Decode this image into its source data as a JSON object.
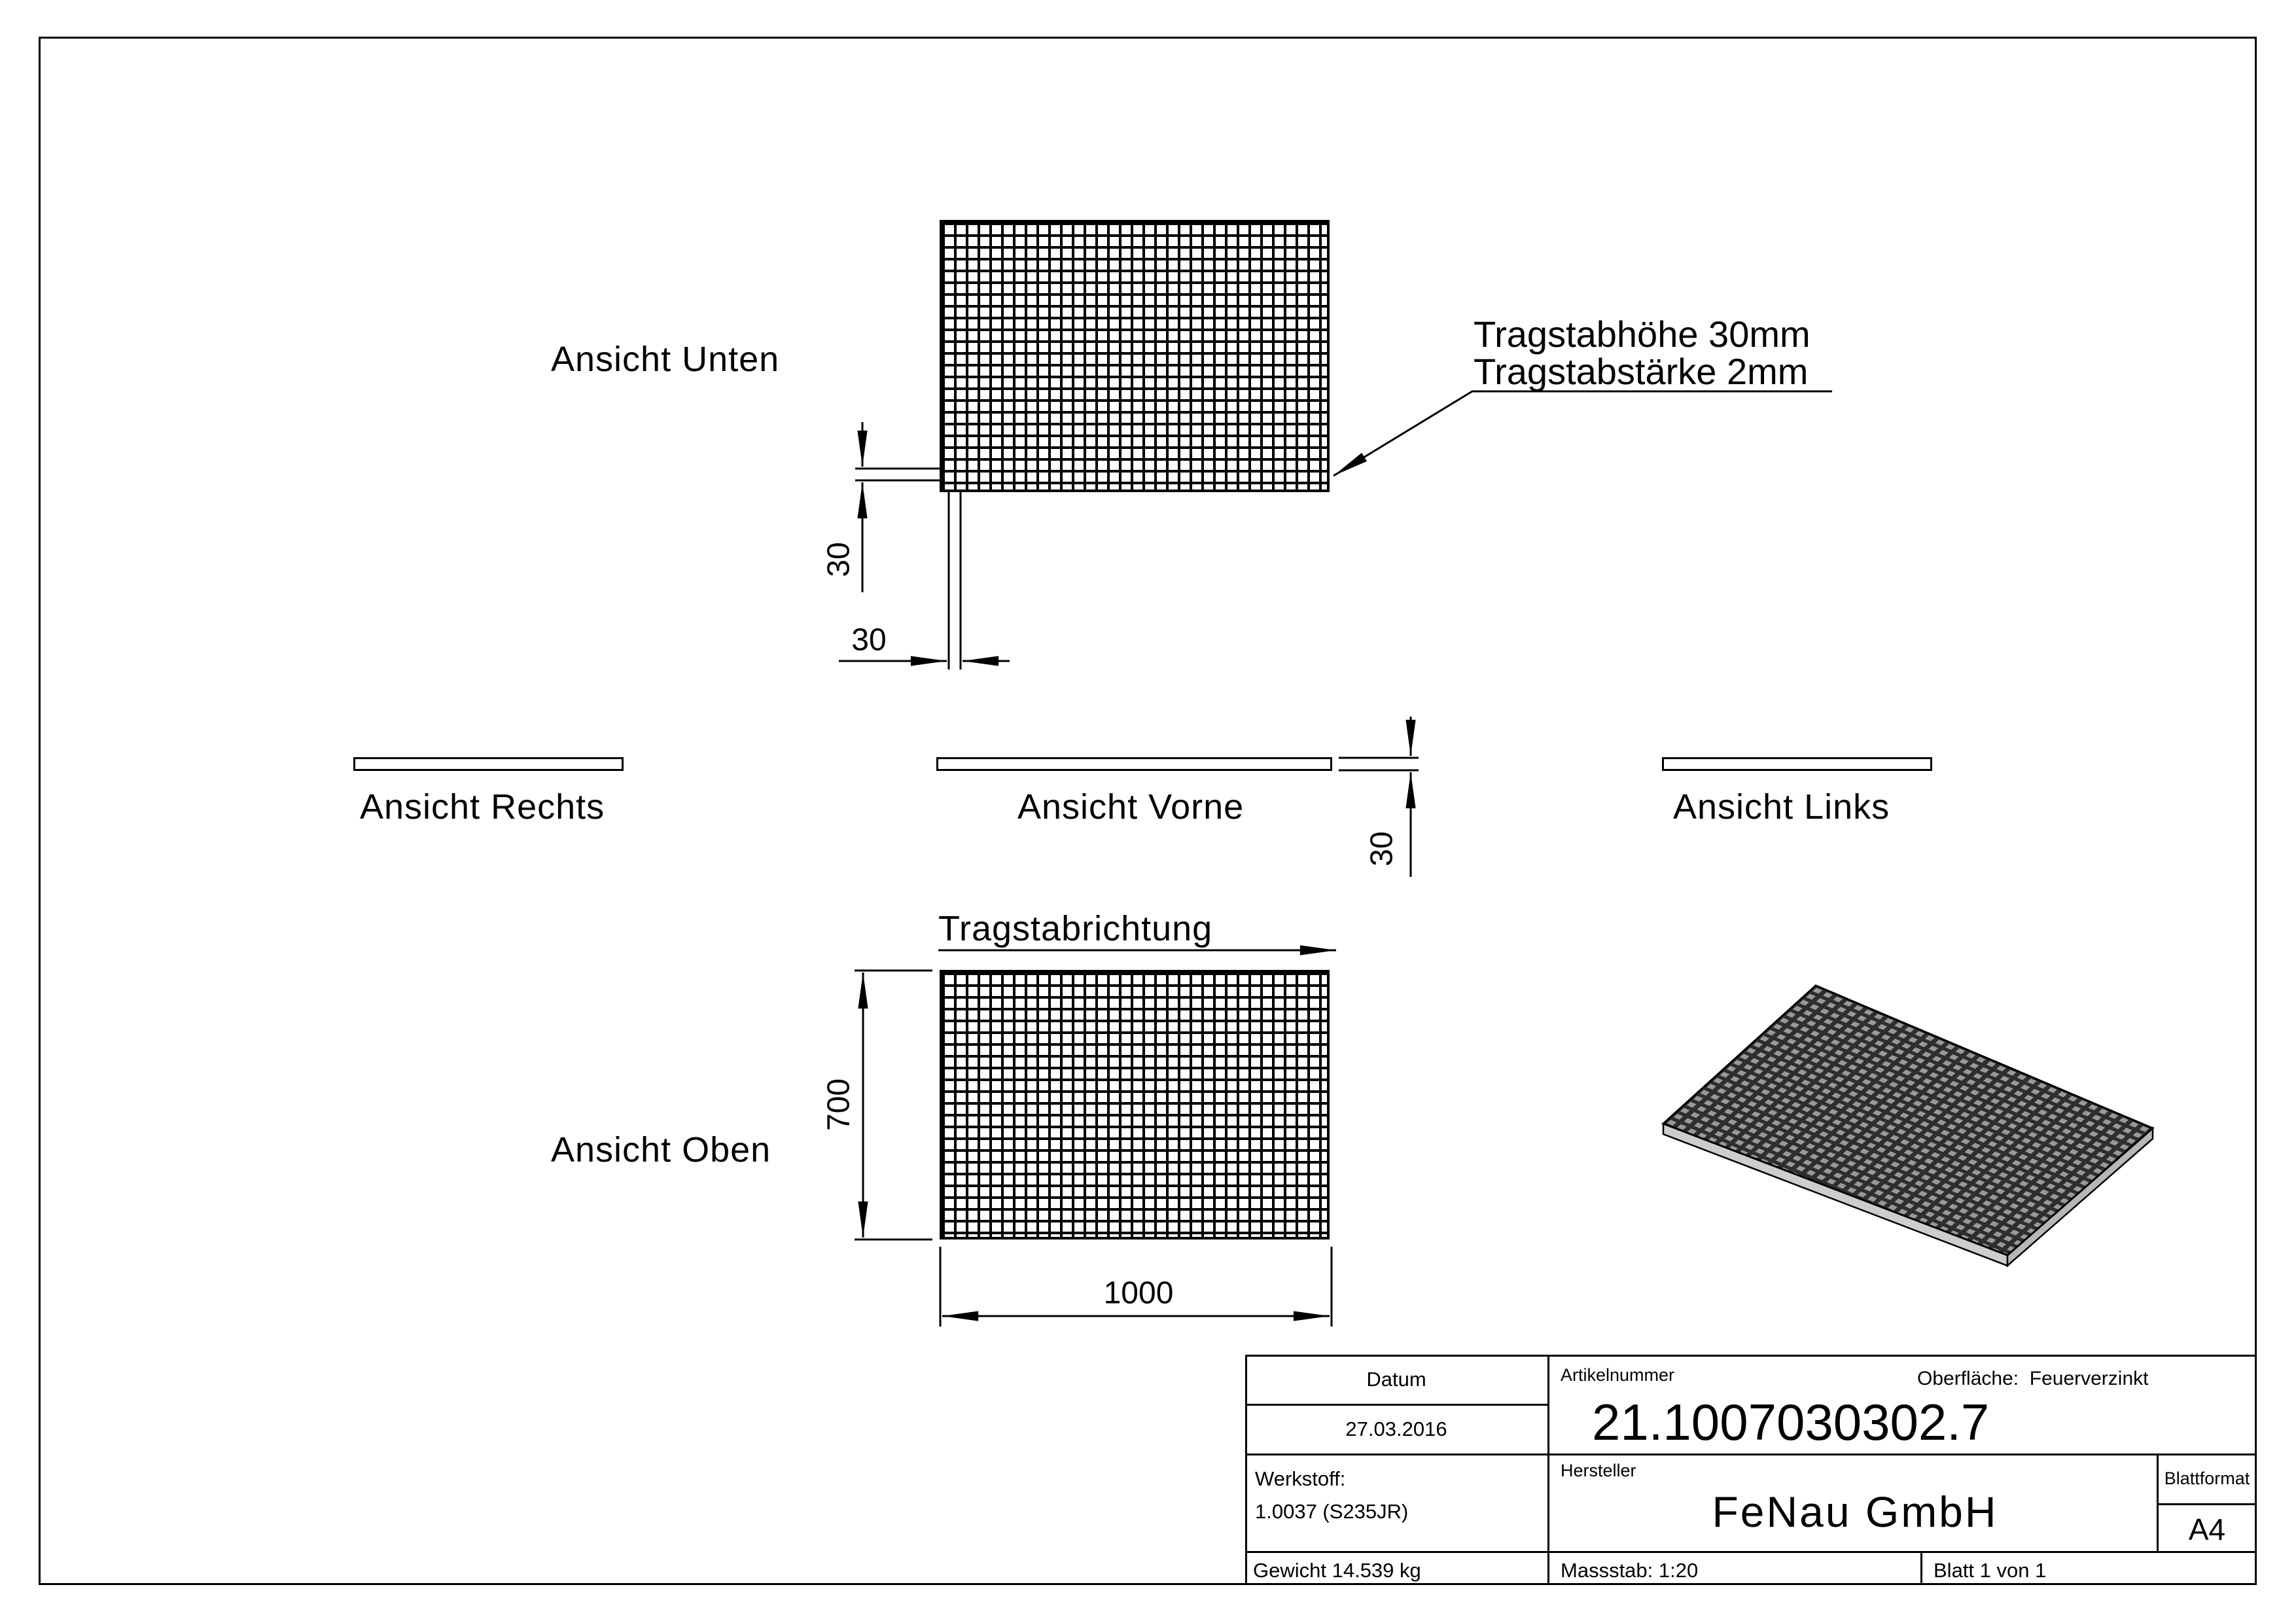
{
  "views": {
    "unten": {
      "label": "Ansicht Unten"
    },
    "rechts": {
      "label": "Ansicht Rechts"
    },
    "vorne": {
      "label": "Ansicht Vorne"
    },
    "links": {
      "label": "Ansicht Links"
    },
    "oben": {
      "label": "Ansicht Oben"
    }
  },
  "annotation": {
    "line1": "Tragstabhöhe 30mm",
    "line2": "Tragstabstärke 2mm"
  },
  "direction_label": "Tragstabrichtung",
  "dimensions": {
    "mesh_pitch_vertical": "30",
    "mesh_pitch_horizontal": "30",
    "grating_height": "30",
    "depth": "700",
    "width": "1000"
  },
  "title_block": {
    "datum_label": "Datum",
    "datum_value": "27.03.2016",
    "artikelnummer_label": "Artikelnummer",
    "artikelnummer_value": "21.1007030302.7",
    "oberflaeche": "Oberfläche:  Feuerverzinkt",
    "werkstoff_label": "Werkstoff:",
    "werkstoff_value": "1.0037 (S235JR)",
    "hersteller_label": "Hersteller",
    "hersteller_value": "FeNau GmbH",
    "blattformat_label": "Blattformat",
    "blattformat_value": "A4",
    "gewicht": "Gewicht 14.539 kg",
    "massstab": "Massstab: 1:20",
    "blatt": "Blatt 1 von 1"
  },
  "colors": {
    "line": "#000000",
    "side_face": "#cdcdcd",
    "side_face_dark": "#b7b7b7",
    "mesh_dark": "#2e2e2e",
    "mesh_hole": "#999999"
  }
}
